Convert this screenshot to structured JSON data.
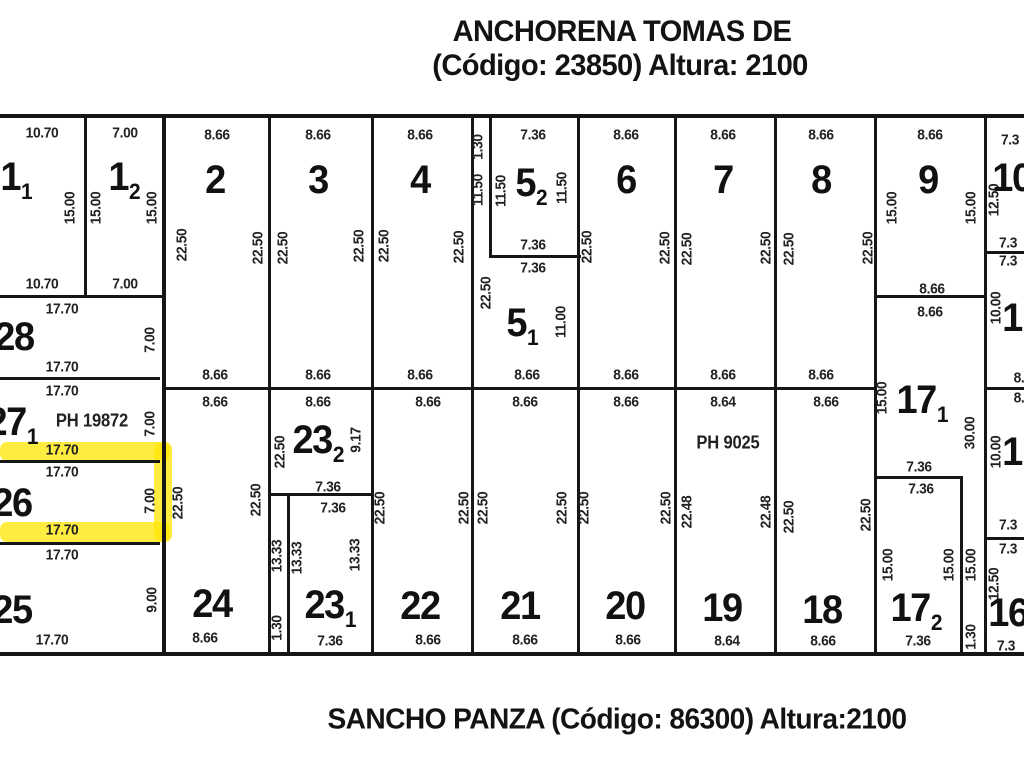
{
  "header": {
    "line1": "ANCHORENA TOMAS DE",
    "line2": "(Código: 23850) Altura: 2100"
  },
  "footer": {
    "line1": "SANCHO PANZA (Código: 86300) Altura:2100"
  },
  "colors": {
    "ink": "#161616",
    "highlight": "#ffe70a",
    "background": "#ffffff"
  },
  "lots": [
    [
      "1",
      "1",
      16,
      177
    ],
    [
      "1",
      "2",
      124,
      177
    ],
    [
      "2",
      "",
      215,
      180
    ],
    [
      "3",
      "",
      318,
      180
    ],
    [
      "4",
      "",
      420,
      180
    ],
    [
      "5",
      "2",
      531,
      183
    ],
    [
      "6",
      "",
      626,
      180
    ],
    [
      "7",
      "",
      723,
      180
    ],
    [
      "8",
      "",
      821,
      180
    ],
    [
      "9",
      "",
      928,
      180
    ],
    [
      "10",
      "",
      1012,
      178
    ],
    [
      "5",
      "1",
      522,
      323
    ],
    [
      "28",
      "",
      14,
      337
    ],
    [
      "27",
      "1",
      12,
      422
    ],
    [
      "26",
      "",
      12,
      503
    ],
    [
      "25",
      "",
      12,
      610
    ],
    [
      "24",
      "",
      212,
      604
    ],
    [
      "23",
      "2",
      318,
      440
    ],
    [
      "23",
      "1",
      330,
      605
    ],
    [
      "22",
      "",
      420,
      606
    ],
    [
      "21",
      "",
      520,
      606
    ],
    [
      "20",
      "",
      625,
      606
    ],
    [
      "19",
      "",
      722,
      608
    ],
    [
      "18",
      "",
      822,
      610
    ],
    [
      "17",
      "1",
      922,
      400
    ],
    [
      "17",
      "2",
      916,
      608
    ],
    [
      "1",
      "",
      1012,
      318
    ],
    [
      "1",
      "",
      1012,
      452
    ],
    [
      "16",
      "",
      1008,
      613
    ]
  ],
  "dims": [
    [
      "10.70",
      42,
      133,
      0
    ],
    [
      "7.00",
      125,
      133,
      0
    ],
    [
      "8.66",
      217,
      135,
      0
    ],
    [
      "8.66",
      318,
      135,
      0
    ],
    [
      "8.66",
      420,
      135,
      0
    ],
    [
      "7.36",
      533,
      135,
      0
    ],
    [
      "8.66",
      626,
      135,
      0
    ],
    [
      "8.66",
      723,
      135,
      0
    ],
    [
      "8.66",
      821,
      135,
      0
    ],
    [
      "8.66",
      930,
      135,
      0
    ],
    [
      "7.3",
      1010,
      140,
      0
    ],
    [
      "15.00",
      70,
      208,
      1
    ],
    [
      "15.00",
      96,
      208,
      1
    ],
    [
      "15.00",
      152,
      208,
      1
    ],
    [
      "22.50",
      182,
      245,
      1
    ],
    [
      "22.50",
      258,
      248,
      1
    ],
    [
      "22.50",
      283,
      248,
      1
    ],
    [
      "22.50",
      359,
      246,
      1
    ],
    [
      "22.50",
      384,
      246,
      1
    ],
    [
      "22.50",
      459,
      247,
      1
    ],
    [
      "1.30",
      478,
      147,
      1
    ],
    [
      "11.50",
      478,
      190,
      1
    ],
    [
      "11.50",
      501,
      191,
      1
    ],
    [
      "11.50",
      562,
      188,
      1
    ],
    [
      "22.50",
      486,
      293,
      1
    ],
    [
      "11.00",
      561,
      322,
      1
    ],
    [
      "22.50",
      587,
      247,
      1
    ],
    [
      "22.50",
      665,
      248,
      1
    ],
    [
      "22.50",
      687,
      249,
      1
    ],
    [
      "22.50",
      766,
      248,
      1
    ],
    [
      "22.50",
      789,
      249,
      1
    ],
    [
      "22.50",
      868,
      248,
      1
    ],
    [
      "15.00",
      892,
      208,
      1
    ],
    [
      "15.00",
      971,
      208,
      1
    ],
    [
      "12.50",
      994,
      200,
      1
    ],
    [
      "7.36",
      533,
      245,
      0
    ],
    [
      "7.36",
      533,
      268,
      0
    ],
    [
      "8.66",
      527,
      375,
      0
    ],
    [
      "8.66",
      215,
      375,
      0
    ],
    [
      "8.66",
      318,
      375,
      0
    ],
    [
      "8.66",
      420,
      375,
      0
    ],
    [
      "8.66",
      626,
      375,
      0
    ],
    [
      "8.66",
      723,
      375,
      0
    ],
    [
      "8.66",
      821,
      375,
      0
    ],
    [
      "8.66",
      932,
      289,
      0
    ],
    [
      "8.66",
      930,
      312,
      0
    ],
    [
      "10.70",
      42,
      284,
      0
    ],
    [
      "7.00",
      125,
      284,
      0
    ],
    [
      "17.70",
      62,
      309,
      0
    ],
    [
      "7.00",
      150,
      340,
      1
    ],
    [
      "17.70",
      62,
      367,
      0
    ],
    [
      "17.70",
      62,
      391,
      0
    ],
    [
      "PH 19872",
      92,
      421,
      0
    ],
    [
      "7.00",
      150,
      424,
      1
    ],
    [
      "17.70",
      62,
      450,
      0
    ],
    [
      "17.70",
      62,
      472,
      0
    ],
    [
      "7.00",
      150,
      501,
      1
    ],
    [
      "17.70",
      62,
      530,
      0
    ],
    [
      "17.70",
      62,
      555,
      0
    ],
    [
      "9.00",
      152,
      600,
      1
    ],
    [
      "17.70",
      52,
      640,
      0
    ],
    [
      "8.66",
      215,
      402,
      0
    ],
    [
      "8.66",
      318,
      402,
      0
    ],
    [
      "8.66",
      428,
      402,
      0
    ],
    [
      "8.66",
      525,
      402,
      0
    ],
    [
      "8.66",
      626,
      402,
      0
    ],
    [
      "8.64",
      723,
      402,
      0
    ],
    [
      "8.66",
      826,
      402,
      0
    ],
    [
      "22.50",
      178,
      503,
      1
    ],
    [
      "22.50",
      256,
      500,
      1
    ],
    [
      "22.50",
      280,
      452,
      1
    ],
    [
      "9.17",
      356,
      440,
      1
    ],
    [
      "13.33",
      277,
      556,
      1
    ],
    [
      "1.30",
      277,
      628,
      1
    ],
    [
      "13.33",
      297,
      558,
      1
    ],
    [
      "13.33",
      355,
      555,
      1
    ],
    [
      "22.50",
      380,
      508,
      1
    ],
    [
      "22.50",
      464,
      508,
      1
    ],
    [
      "22.50",
      483,
      508,
      1
    ],
    [
      "22.50",
      562,
      508,
      1
    ],
    [
      "22.50",
      584,
      508,
      1
    ],
    [
      "22.50",
      666,
      508,
      1
    ],
    [
      "22.48",
      687,
      512,
      1
    ],
    [
      "22.48",
      766,
      512,
      1
    ],
    [
      "22.50",
      789,
      517,
      1
    ],
    [
      "22.50",
      866,
      515,
      1
    ],
    [
      "15.00",
      882,
      398,
      1
    ],
    [
      "30.00",
      970,
      433,
      1
    ],
    [
      "15.00",
      888,
      565,
      1
    ],
    [
      "15.00",
      949,
      565,
      1
    ],
    [
      "15.00",
      971,
      565,
      1
    ],
    [
      "1.30",
      971,
      637,
      1
    ],
    [
      "10.00",
      996,
      308,
      1
    ],
    [
      "10.00",
      996,
      452,
      1
    ],
    [
      "12.50",
      994,
      584,
      1
    ],
    [
      "7.36",
      328,
      487,
      0
    ],
    [
      "7.36",
      333,
      508,
      0
    ],
    [
      "7.36",
      330,
      641,
      0
    ],
    [
      "7.36",
      919,
      467,
      0
    ],
    [
      "7.36",
      921,
      489,
      0
    ],
    [
      "7.36",
      918,
      641,
      0
    ],
    [
      "PH 9025",
      728,
      443,
      0
    ],
    [
      "8.66",
      205,
      638,
      0
    ],
    [
      "8.66",
      428,
      640,
      0
    ],
    [
      "8.66",
      525,
      640,
      0
    ],
    [
      "8.66",
      628,
      640,
      0
    ],
    [
      "8.64",
      727,
      641,
      0
    ],
    [
      "8.66",
      823,
      641,
      0
    ],
    [
      "7.3",
      1008,
      243,
      0
    ],
    [
      "7.3",
      1008,
      261,
      0
    ],
    [
      "8.",
      1019,
      378,
      0
    ],
    [
      "8.",
      1019,
      398,
      0
    ],
    [
      "7.3",
      1008,
      525,
      0
    ],
    [
      "7.3",
      1008,
      549,
      0
    ],
    [
      "7.3",
      1006,
      646,
      0
    ]
  ],
  "lines": [
    [
      0,
      114,
      1024,
      4
    ],
    [
      0,
      652,
      1024,
      4
    ],
    [
      84,
      117,
      3,
      180
    ],
    [
      162,
      117,
      4,
      536
    ],
    [
      0,
      295,
      163,
      3
    ],
    [
      0,
      377,
      160,
      3
    ],
    [
      0,
      460,
      160,
      3
    ],
    [
      0,
      542,
      160,
      3
    ],
    [
      268,
      117,
      3,
      536
    ],
    [
      371,
      117,
      3,
      536
    ],
    [
      471,
      117,
      3,
      536
    ],
    [
      489,
      117,
      3,
      140
    ],
    [
      489,
      255,
      92,
      3
    ],
    [
      577,
      117,
      3,
      536
    ],
    [
      674,
      117,
      3,
      536
    ],
    [
      774,
      117,
      3,
      536
    ],
    [
      874,
      117,
      3,
      536
    ],
    [
      984,
      117,
      3,
      536
    ],
    [
      166,
      387,
      711,
      3
    ],
    [
      874,
      295,
      113,
      3
    ],
    [
      874,
      476,
      89,
      3
    ],
    [
      268,
      493,
      106,
      3
    ],
    [
      287,
      493,
      3,
      160
    ],
    [
      960,
      476,
      3,
      177
    ],
    [
      984,
      251,
      40,
      3
    ],
    [
      984,
      387,
      40,
      3
    ],
    [
      984,
      537,
      40,
      3
    ]
  ],
  "highlights": [
    [
      0,
      442,
      170,
      19
    ],
    [
      0,
      522,
      170,
      20
    ],
    [
      154,
      442,
      18,
      100
    ]
  ]
}
